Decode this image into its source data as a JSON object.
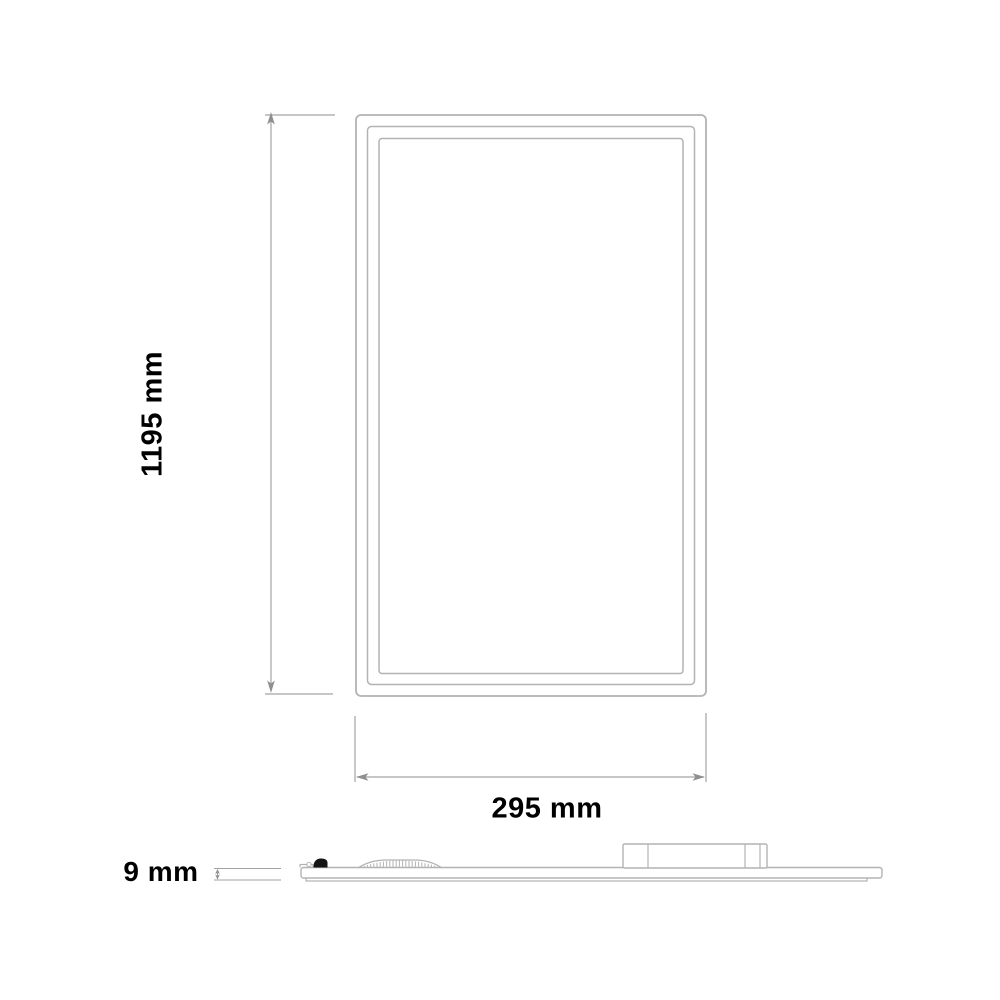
{
  "diagram": {
    "type": "technical-dimension-drawing",
    "subject": "flat LED panel light, front view and side profile",
    "front_view": {
      "height_label": "1195 mm",
      "width_label": "295 mm"
    },
    "side_view": {
      "thickness_label": "9 mm"
    },
    "dimensions": {
      "height_mm": 1195,
      "width_mm": 295,
      "thickness_mm": 9
    },
    "colors": {
      "background": "#ffffff",
      "drawing_line": "#b3b3b3",
      "dimension_line": "#a3a3a3",
      "arrow": "#8f8f8f",
      "label_text": "#000000"
    }
  }
}
